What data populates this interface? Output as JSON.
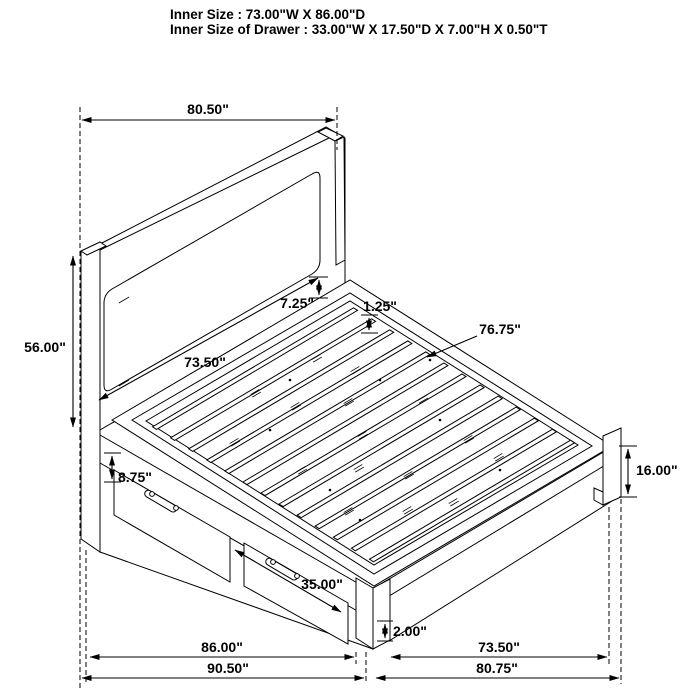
{
  "title": {
    "line1": "Inner Size : 73.00\"W X 86.00\"D",
    "line2": "Inner Size of Drawer : 33.00\"W X 17.50\"D X 7.00\"H X 0.50\"T"
  },
  "dims": {
    "headboard_width": "80.50\"",
    "bed_height": "56.00\"",
    "headboard_panel_width": "73.50\"",
    "panel_to_rail_gap": "7.25\"",
    "slat_recess": "1.25\"",
    "slat_area_depth": "76.75\"",
    "side_rail_height": "8.75\"",
    "footboard_leg_height": "16.00\"",
    "drawer_front_width": "35.00\"",
    "floor_clearance": "2.00\"",
    "frame_depth": "86.00\"",
    "overall_depth": "90.50\"",
    "inner_platform_width": "73.50\"",
    "overall_width": "80.75\""
  },
  "colors": {
    "line": "#000000",
    "background": "#ffffff"
  }
}
